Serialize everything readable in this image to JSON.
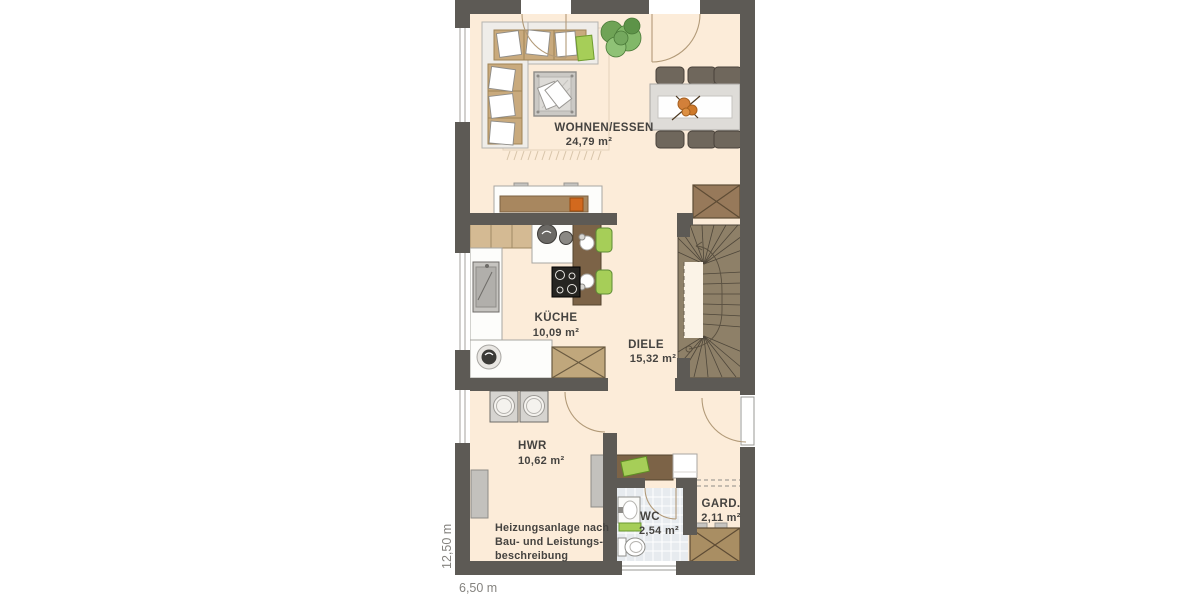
{
  "title": "floor-plan-ground-floor",
  "rooms": [
    {
      "name": "WOHNEN/ESSEN",
      "area": "24,79 m²"
    },
    {
      "name": "KÜCHE",
      "area": "10,09 m²"
    },
    {
      "name": "DIELE",
      "area": "15,32 m²"
    },
    {
      "name": "HWR",
      "area": "10,62 m²"
    },
    {
      "name": "WC",
      "area": "2,54 m²"
    },
    {
      "name": "GARD.",
      "area": "2,11 m²"
    }
  ],
  "note_lines": [
    "Heizungsanlage nach",
    "Bau- und Leistungs-",
    "beschreibung"
  ],
  "dimensions": {
    "width_label": "6,50 m",
    "height_label": "12,50 m"
  },
  "colors": {
    "wall": "#5d5a55",
    "floor": "#fcecd9",
    "counter": "#fdfdfb",
    "wood": "#7c6347",
    "wood_light": "#c9aa7d",
    "shaft": "#97795a",
    "stair": "#8e8068",
    "tile": "#e7ebef",
    "green": "#a6ce58",
    "chair": "#6f675c",
    "table": "#dedcd8",
    "arc": "#b29a78"
  }
}
